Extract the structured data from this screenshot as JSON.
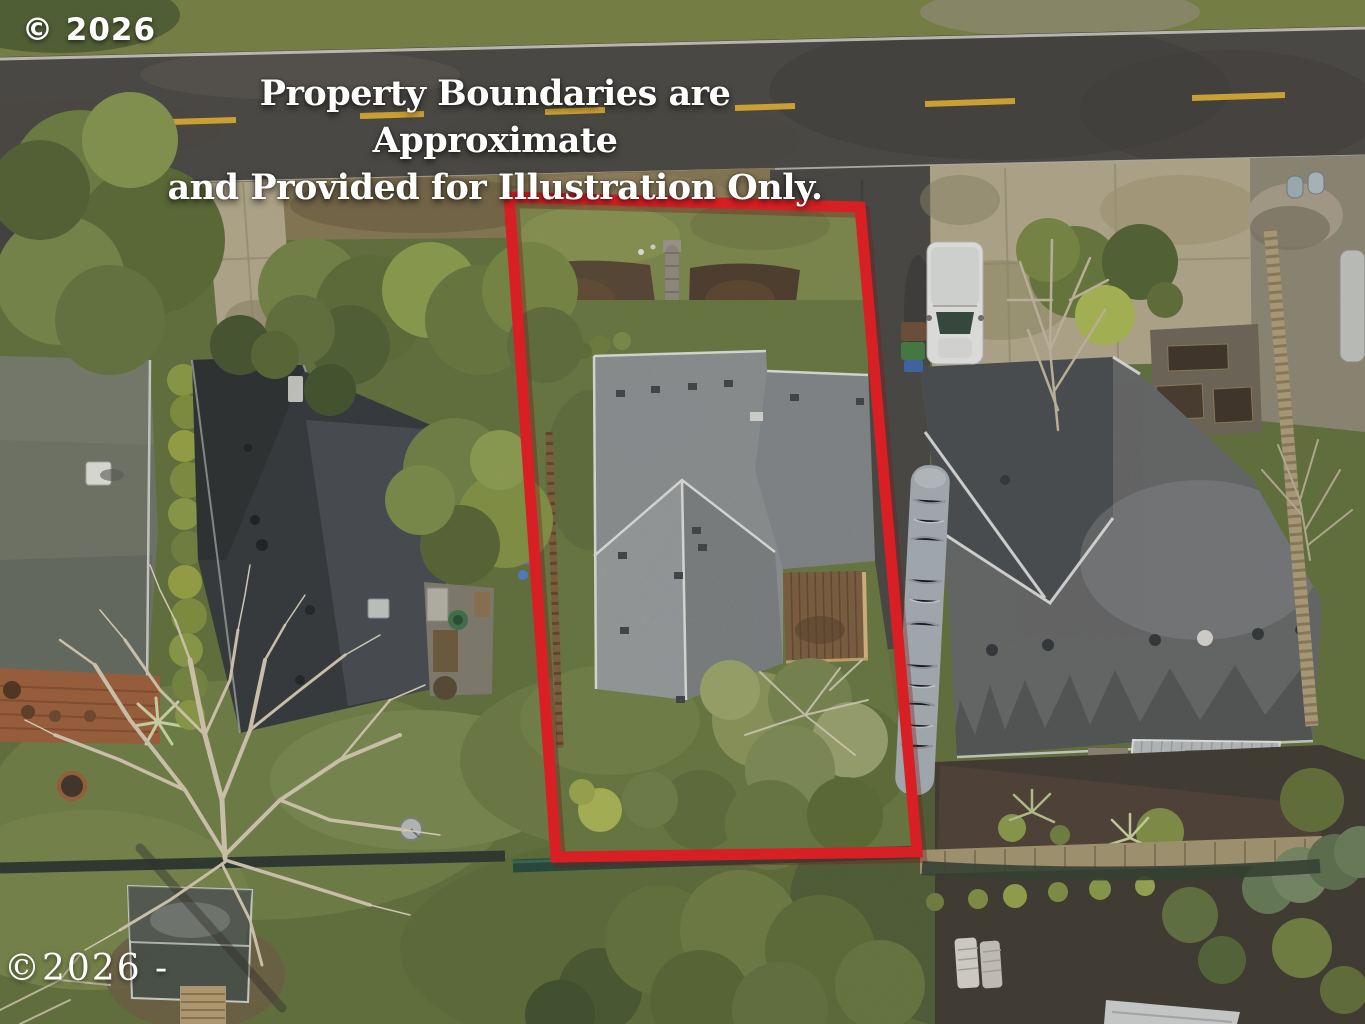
{
  "meta": {
    "description_label": "aerial-drone-photo-of-residential-lot-with-highlighted-boundary",
    "width_px": 1365,
    "height_px": 1024
  },
  "disclaimer": {
    "line1": "Property Boundaries are Approximate",
    "line2": "and Provided for Illustration Only."
  },
  "watermarks": {
    "top_left": "© 2026",
    "bottom_left": "©2026 -"
  },
  "scene": {
    "boundary_outline": {
      "color": "#e8161b",
      "shape": "quadrilateral"
    },
    "road": {
      "surface_color": "#4e4b47",
      "edge_line_color": "#d9d6cd",
      "center_dash_color": "#d9a82b"
    },
    "palette": {
      "grass": "#65753a",
      "olive_verge": "#76813f",
      "subject_roof": "#9fa4a6",
      "left_house_roof_mossy": "#6d7263",
      "neighbor_roof_dark": "#2f3335",
      "right_house_roof": "#7b7d7e",
      "deck_wood": "#7b5a3b",
      "concrete": "#b3a88b",
      "mulch": "#54412f",
      "tarp_boat": "#a7aeb5",
      "white_van": "#e9eae8"
    },
    "objects": [
      "red-boundary-outline",
      "asphalt-road",
      "yellow-center-dashes",
      "white-edge-lines",
      "subject-house-gray-roof",
      "subject-wood-deck",
      "stone-walkway",
      "mulch-garden-beds",
      "left-house-mossy-roof",
      "left-house-deck",
      "dark-roof-neighbor-house",
      "hedge-row",
      "right-house-gray-roof",
      "corrugated-patio-cover",
      "white-van",
      "trash-bins",
      "wrapped-boat-tarp",
      "wood-fence",
      "dark-green-fence",
      "bare-winter-tree",
      "garden-shed",
      "fire-pit",
      "satellite-dish",
      "raised-garden-beds",
      "lounge-chairs",
      "rv-roof-bottom-edge",
      "gravel-pile",
      "storage-cylinders"
    ]
  }
}
